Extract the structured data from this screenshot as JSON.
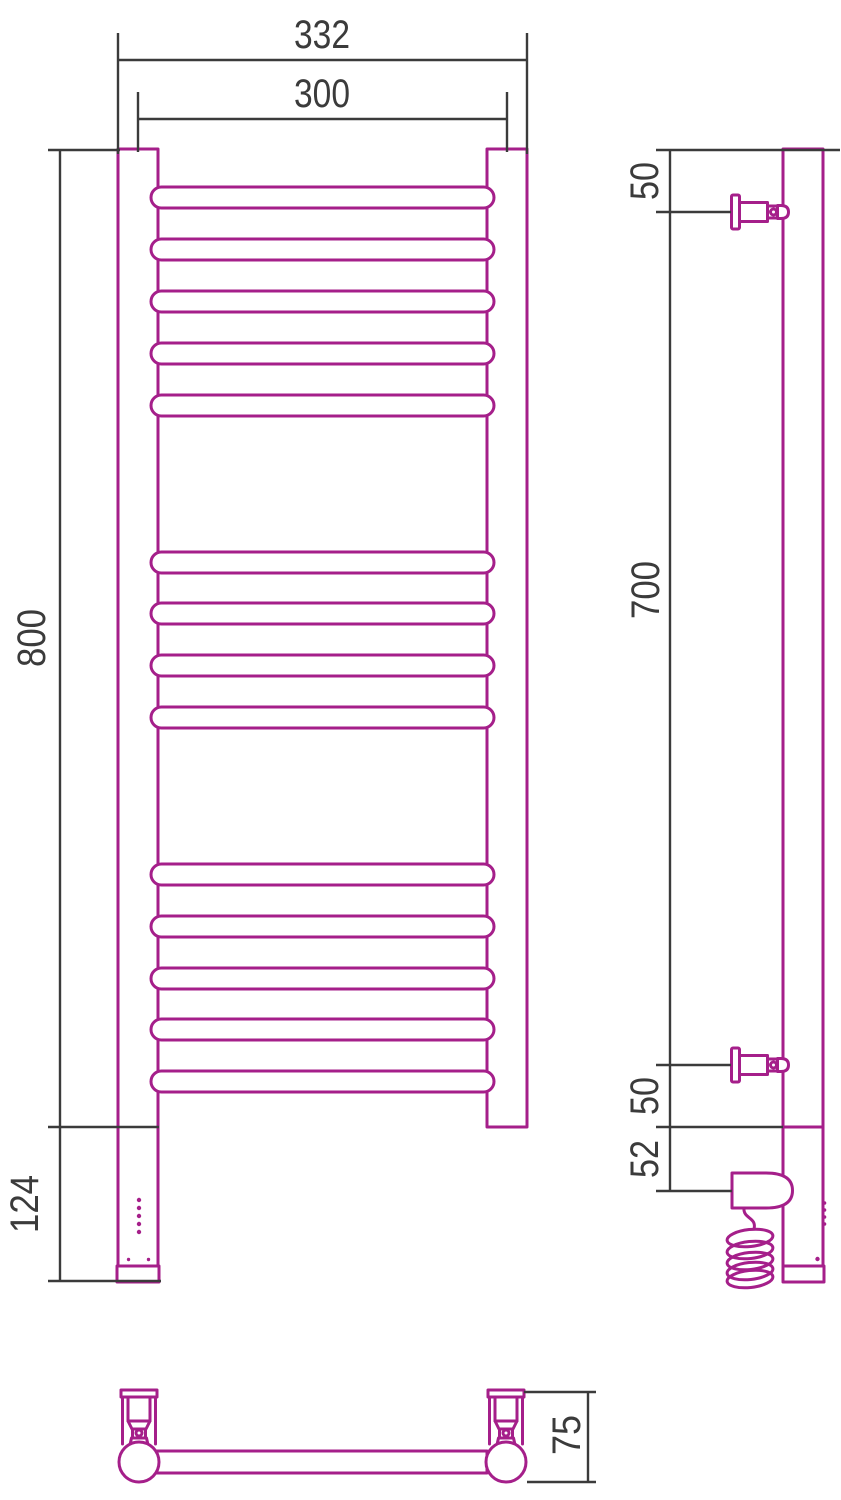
{
  "palette": {
    "outline": "#a51f8a",
    "dimension_lines": "#3b3b3b",
    "background": "#ffffff"
  },
  "front_view": {
    "dim_overall_width": "332",
    "dim_center_width": "300",
    "dim_height": "800",
    "dim_heater_section": "124",
    "rung_rows_y": [
      187,
      239,
      291,
      343,
      395,
      552,
      603,
      655,
      707,
      864,
      916,
      968,
      1019,
      1071
    ],
    "indicator_dots_y": [
      1200,
      1208,
      1216,
      1224,
      1232
    ]
  },
  "side_view": {
    "dim_top_bracket": "50",
    "dim_bracket_span": "700",
    "dim_bottom_bracket": "50",
    "dim_heater_axis": "52",
    "led_dots_y": [
      1203,
      1210,
      1217,
      1224
    ]
  },
  "bottom_view": {
    "dim_depth": "75"
  }
}
